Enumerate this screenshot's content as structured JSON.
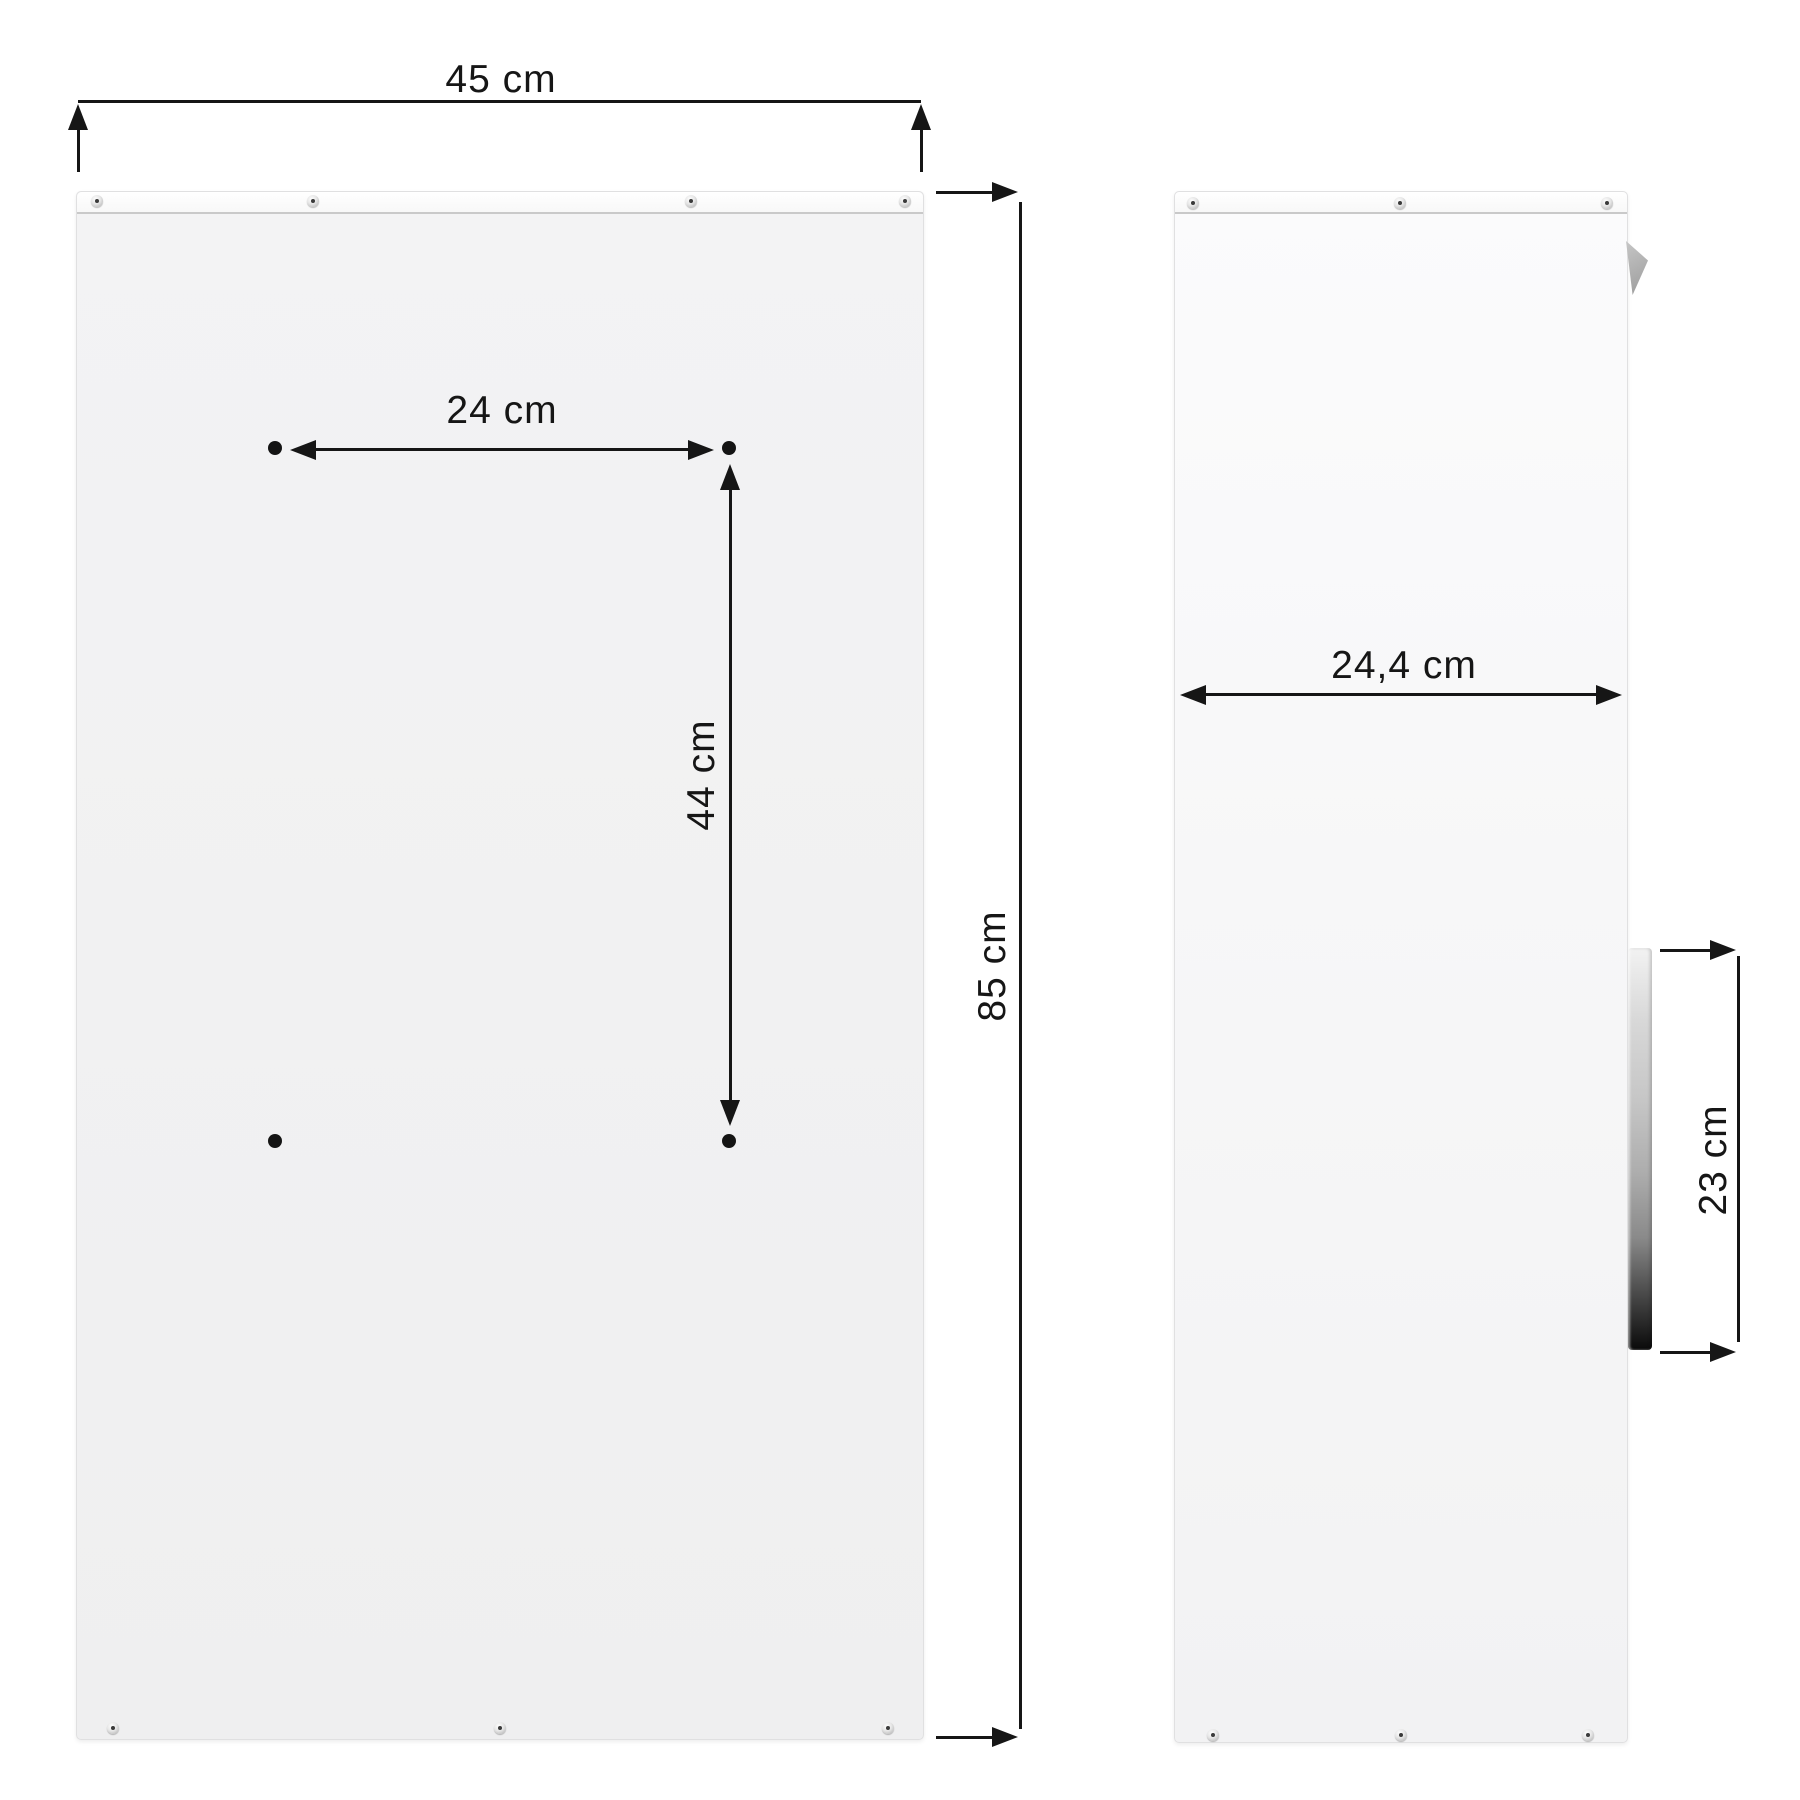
{
  "diagram": {
    "views": {
      "front": {
        "width_label": "45 cm",
        "hole_spacing_width_label": "24 cm",
        "hole_spacing_height_label": "44 cm",
        "height_label": "85 cm"
      },
      "side": {
        "depth_label": "24,4 cm",
        "handle_height_label": "23 cm"
      }
    },
    "colors": {
      "background": "#ffffff",
      "panel_front": "#f0f0f1",
      "panel_side": "#f8f8f9",
      "rail": "#fcfcfc",
      "dimension_lines": "#161616",
      "handle_dark": "#0a0a0a",
      "flap_gray": "#a9a9a9"
    }
  }
}
